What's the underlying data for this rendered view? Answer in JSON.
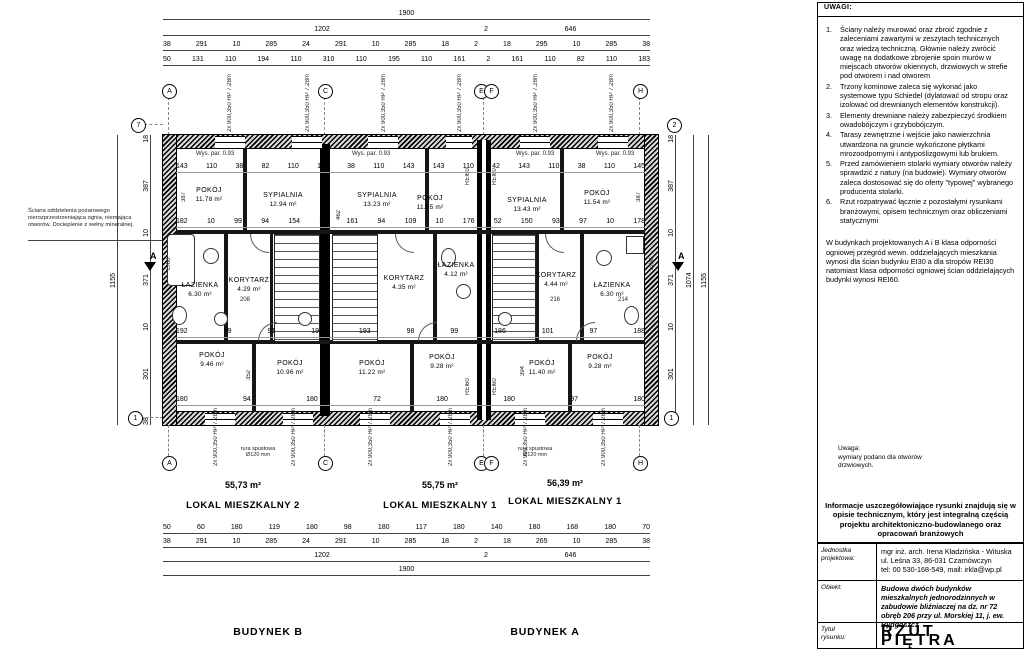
{
  "plan": {
    "rooms": [
      {
        "name": "POKÓJ",
        "area": "11.78 m²"
      },
      {
        "name": "SYPIALNIA",
        "area": "12.94 m²"
      },
      {
        "name": "SYPIALNIA",
        "area": "13.23 m²"
      },
      {
        "name": "POKÓJ",
        "area": "11.55 m²"
      },
      {
        "name": "SYPIALNIA",
        "area": "13.43 m²"
      },
      {
        "name": "POKÓJ",
        "area": "11.54 m²"
      },
      {
        "name": "ŁAZIENKA",
        "area": "6.30 m²"
      },
      {
        "name": "KORYTARZ",
        "area": "4.29 m²"
      },
      {
        "name": "KORYTARZ",
        "area": "4.35 m²"
      },
      {
        "name": "ŁAZIENKA",
        "area": "4.12 m²"
      },
      {
        "name": "KORYTARZ",
        "area": "4.44 m²"
      },
      {
        "name": "ŁAZIENKA",
        "area": "6.30 m²"
      },
      {
        "name": "POKÓJ",
        "area": "9.46 m²"
      },
      {
        "name": "POKÓJ",
        "area": "10.96 m²"
      },
      {
        "name": "POKÓJ",
        "area": "11.22 m²"
      },
      {
        "name": "POKÓJ",
        "area": "9.28 m²"
      },
      {
        "name": "POKÓJ",
        "area": "11.40 m²"
      },
      {
        "name": "POKÓJ",
        "area": "9.28 m²"
      }
    ],
    "units": [
      {
        "area": "55,73 m²",
        "label": "LOKAL MIESZKALNY 2"
      },
      {
        "area": "55,75 m²",
        "label": "LOKAL MIESZKALNY 1"
      },
      {
        "area": "56,39 m²",
        "label": "LOKAL MIESZKALNY 1"
      }
    ],
    "buildings": [
      "BUDYNEK B",
      "BUDYNEK A"
    ],
    "dims": {
      "top_total": "1900",
      "top_sub_l": "1202",
      "top_sub_m": "2",
      "top_sub_r": "646",
      "top_row1": "38 291 10 285 24 291 10 285 18 2 18 295 10 285 38",
      "top_row2": "50 131 110 194 110 310 110 195 110 161 2 161 110 82 110 183",
      "bot_row1": "50 60 180 119 180 98 180 117 180 140 180 168 180 70",
      "bot_row2": "38 291 10 285 24 291 10 285 18 2 18 265 10 285 38",
      "bot_sub_l": "1202",
      "bot_sub_m": "2",
      "bot_sub_r": "646",
      "bot_total": "1900",
      "left_segs": "38 301 10 371 10 387 18",
      "left_total": "1155",
      "right_segs": "38 301 10 371 10 387 18",
      "right_total": "1155",
      "right_inner": "1074"
    },
    "inner": {
      "r_sill": "143 110 38 82 110 143 38 110 143 143 110 42 143 110 38 110 145",
      "r_mid": "182 10 99 94 154 36 161 94 109 10 176 52 150 93 97 10 178",
      "r_corr": "192 99 91 194 193 98 99 186 101 97 188",
      "r_bot": "180 94 180 72 180 180 97 180",
      "d208": "208",
      "d216": "216",
      "d214": "214",
      "v387": "387",
      "v462": "462",
      "v394": "394",
      "v352": "352"
    },
    "axes": {
      "t1": "A",
      "t2": "C",
      "t3": "E",
      "t4": "F",
      "t5": "H",
      "l_top": "7",
      "l_bot": "1",
      "r_top": "2",
      "r_bot": "1"
    },
    "annotations": {
      "fire_wall": "Ściana oddzielenia pożarowego nierozprzestrzeniająca ognia, niemająca otworów. Docieplenie z wełny mineralnej.",
      "rura": "rura spustowa\nØ120 mm",
      "wys_par": "Wys. par. 0.93",
      "win_mark": "2x 900,350 HP  7.28m",
      "rei60": "REI60",
      "ei60": "EI60",
      "section": "A"
    }
  },
  "panel": {
    "uwagi_title": "UWAGI:",
    "notes": [
      {
        "n": "1.",
        "t": "Ściany należy murować oraz zbroić zgodnie z zaleceniami zawartymi w zeszytach technicznych oraz wiedzą techniczną. Głównie należy zwrócić uwagę na dodatkowe zbrojenie spoin murów w miejscach otworów okiennych, drzwiowych w strefie pod otworem i nad otworem"
      },
      {
        "n": "2.",
        "t": "Trzony kominowe zaleca się wykonać jako systemowe typu Schiedel (dylatować od stropu oraz izolować od drewnianych elementów konstrukcji)."
      },
      {
        "n": "3.",
        "t": "Elementy drewniane należy zabezpieczyć środkiem owadobójczym i grzybobójczym."
      },
      {
        "n": "4.",
        "t": "Tarasy zewnętrzne i wejście jako nawierzchnia utwardzona na gruncie wykończone płytkami mrozoodpornymi i antypoślizgowymi lub brukiem."
      },
      {
        "n": "5.",
        "t": "Przed zamówieniem stolarki wymiary otworów należy sprawdzić z natury (na budowie). Wymiary otworów zaleca dostosować się do oferty \"typowej\" wybranego producenta stolarki."
      },
      {
        "n": "6.",
        "t": "Rzut rozpatrywać łącznie z pozostałymi rysunkami branżowymi, opisem technicznym oraz obliczeniami statycznymi"
      }
    ],
    "fire_note": "W budynkach projektowanych A i B klasa odporności ogniowej przegród wewn. oddzielających mieszkania wynosi dla ścian budynku EI30 a dla stropów REI30 natomiast klasa odporności ogniowej ścian oddzielających budynki wynosi REI60.",
    "uwaga_small": "Uwaga:\nwymiary  podano dla otworów\ndrzwiowych.",
    "info_bold": "Informacje uszczegółowiające rysunki znajdują się w opisie technicznym, który jest integralną częścią projektu architektoniczno-budowlanego oraz opracowań branżowych",
    "tb": {
      "jed_label": "Jednostka\nprojektowa:",
      "jed_1": "mgr inż. arch. Irena Kładzińska - Wituska",
      "jed_2": "ul. Leśna 33, 86-031 Czarnówczyn",
      "jed_3": "tel: 00 530-168-549, mail: irkla@wp.pl",
      "ob_label": "Obiekt:",
      "ob_text": "Budowa dwóch budynków mieszkalnych jednorodzinnych  w zabudowie bliźniaczej na dz. nr 72 obręb 206 przy ul. Morskiej 11,  j. ew.  Bydgoszcz",
      "tyt_label": "Tytuł\nrysunku:",
      "tyt_text": "RZUT PIĘTRA"
    }
  }
}
